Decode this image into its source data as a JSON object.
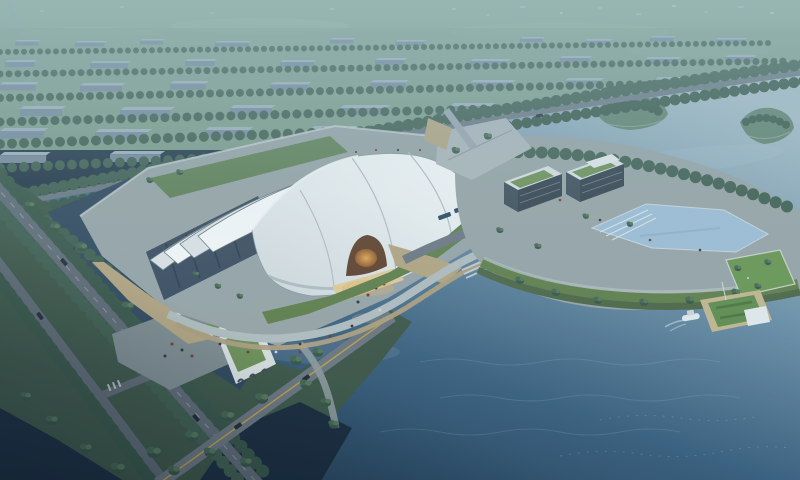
{
  "meta": {
    "type": "architectural-aerial-rendering",
    "setting": "hazy dusk aerial view of a lakeside cultural venue",
    "no_visible_text": true
  },
  "scene": {
    "main_hall": "large white segmented curved-shell exhibition hall with glowing orange arched entrance on a lawn apron",
    "city": "misty low-rise city blocks and tree rows behind a riverside tree-lined avenue",
    "lake": "broad slate-blue lake wrapping the site, lighter and hazier toward the horizon",
    "peninsula": "curved landscaped peninsula with dark green-roof buildings, reflecting pool and lawn terraces",
    "office_building": "L-shaped white building with planted green roof, entry canopy and plaza",
    "pier": "small pier platform with hedge garden, white hut and a moored boat",
    "roads": "tree-lined avenues with light traffic, a water-crossing bridge and parking with buses",
    "islands": "tree-covered islets in the upper lake channel"
  },
  "palette": {
    "field_top": "#8fab97",
    "field_bottom": "#7a9a85",
    "city_top": "#9fb0bd",
    "city_front": "#76879a",
    "tree_dark": "#33503f",
    "tree_mid": "#41624c",
    "tree_light": "#547457",
    "water_light": "#a9bec8",
    "water_mid": "#6f92aa",
    "water_deep": "#375d7c",
    "water_darkest": "#1d374e",
    "channel": "#2b4156",
    "pond_dark": "#152638",
    "road": "#5d6771",
    "road_bridge": "#6a747e",
    "road_river": "#6a7580",
    "lane_yellow": "#c1a041",
    "pavement": "#99a3a5",
    "plaza": "#aeb6ba",
    "promenade": "#b4bec0",
    "boardwalk": "#b09f7c",
    "sand": "#b6a47d",
    "lawn": "#5d7c45",
    "lawn_bright": "#67944c",
    "slope": "#49623f",
    "shell_bright": "#ffffff",
    "shell_mid": "#e3e8ea",
    "shell_shade": "#d8dfe2",
    "glass_dark": "#36465a",
    "entrance_dark": "#5e3a22",
    "entrance_glow": "#e8a54e",
    "apron": "#e9cd90",
    "roof_green": "#6d8f52",
    "building_white": "#dfe5e4",
    "dark_block": "#2f3b47",
    "pool": "#9fc0d8",
    "pier": "#c6b78d",
    "pier_green": "#5d8a49",
    "hut": "#e9edee",
    "boat": "#e6edf0",
    "vehicle_dark": "#1c2630",
    "bus_blue": "#27425d",
    "island_green": "#5e7f68",
    "land_dark": "#3a5242"
  }
}
